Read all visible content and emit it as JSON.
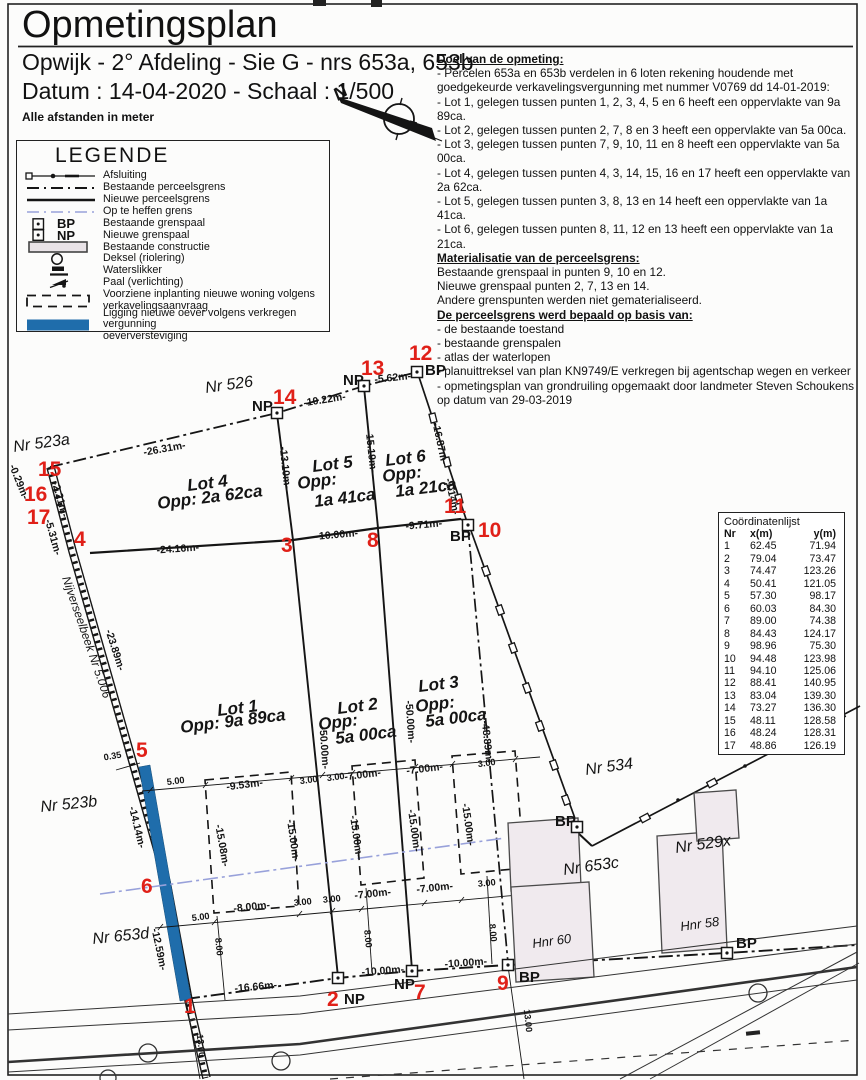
{
  "header": {
    "title": "Opmetingsplan",
    "subtitle": "Opwijk - 2° Afdeling - Sie G - nrs 653a, 653b",
    "date_scale": "Datum : 14-04-2020  -  Schaal : 1/500",
    "units_note": "Alle afstanden in meter",
    "north_label": "N"
  },
  "notes": {
    "s1_title": "Doel van de opmeting:",
    "s1_lines": [
      "- Percelen 653a en 653b verdelen in 6 loten rekening houdende met goedgekeurde verkavelingsvergunning met nummer V0769 dd 14-01-2019:",
      "- Lot 1, gelegen tussen punten 1, 2, 3, 4, 5 en 6 heeft een oppervlakte van 9a 89ca.",
      "- Lot 2, gelegen tussen punten 2, 7, 8 en 3 heeft een oppervlakte van 5a 00ca.",
      "- Lot 3, gelegen tussen punten 7, 9, 10, 11 en 8 heeft een oppervlakte van 5a 00ca.",
      "- Lot 4, gelegen tussen punten 4, 3, 14, 15, 16 en 17 heeft een oppervlakte van 2a 62ca.",
      "- Lot 5, gelegen tussen punten 3, 8, 13 en 14 heeft een oppervlakte van 1a 41ca.",
      "- Lot 6, gelegen tussen punten 8, 11, 12 en 13 heeft een oppervlakte van 1a 21ca."
    ],
    "s2_title": "Materialisatie van de perceelsgrens:",
    "s2_lines": [
      "Bestaande grenspaal in punten 9, 10 en 12.",
      "Nieuwe grenspaal punten 2, 7, 13 en 14.",
      "Andere grenspunten werden niet gematerialiseerd."
    ],
    "s3_title": "De perceelsgrens werd bepaald op basis van:",
    "s3_lines": [
      "- de bestaande toestand",
      "- bestaande grenspalen",
      "- atlas der waterlopen",
      "- planuittreksel van plan KN9749/E verkregen bij agentschap wegen en verkeer",
      "- opmetingsplan van grondruiling opgemaakt door landmeter Steven Schoukens op datum van 29-03-2019"
    ]
  },
  "legend": {
    "title": "LEGENDE",
    "bp": "BP",
    "np": "NP",
    "items": [
      {
        "lines": [
          "Afsluiting"
        ]
      },
      {
        "lines": [
          "Bestaande perceelsgrens"
        ]
      },
      {
        "lines": [
          "Nieuwe perceelsgrens"
        ]
      },
      {
        "lines": [
          "Op te heffen grens"
        ]
      },
      {
        "lines": [
          "Bestaande grenspaal"
        ]
      },
      {
        "lines": [
          "Nieuwe grenspaal"
        ]
      },
      {
        "lines": [
          "Bestaande constructie"
        ]
      },
      {
        "lines": [
          "Deksel (riolering)"
        ]
      },
      {
        "lines": [
          "Waterslikker"
        ]
      },
      {
        "lines": [
          "Paal (verlichting)"
        ]
      },
      {
        "lines": [
          "Voorziene inplanting nieuwe woning volgens",
          "verkavelingsaanvraag"
        ]
      },
      {
        "lines": [
          "Ligging nieuwe oever volgens verkregen vergunning",
          "oeverversteviging"
        ]
      }
    ]
  },
  "coord_table": {
    "title": "Coördinatenlijst",
    "columns": [
      "Nr",
      "x(m)",
      "y(m)"
    ],
    "rows": [
      [
        "1",
        "62.45",
        "71.94"
      ],
      [
        "2",
        "79.04",
        "73.47"
      ],
      [
        "3",
        "74.47",
        "123.26"
      ],
      [
        "4",
        "50.41",
        "121.05"
      ],
      [
        "5",
        "57.30",
        "98.17"
      ],
      [
        "6",
        "60.03",
        "84.30"
      ],
      [
        "7",
        "89.00",
        "74.38"
      ],
      [
        "8",
        "84.43",
        "124.17"
      ],
      [
        "9",
        "98.96",
        "75.30"
      ],
      [
        "10",
        "94.48",
        "123.98"
      ],
      [
        "11",
        "94.10",
        "125.06"
      ],
      [
        "12",
        "88.41",
        "140.95"
      ],
      [
        "13",
        "83.04",
        "139.30"
      ],
      [
        "14",
        "73.27",
        "136.30"
      ],
      [
        "15",
        "48.11",
        "128.58"
      ],
      [
        "16",
        "48.24",
        "128.31"
      ],
      [
        "17",
        "48.86",
        "126.19"
      ]
    ]
  },
  "plan": {
    "colors": {
      "accent_red": "#e02018",
      "water_blue": "#1f6dab",
      "removed_boundary_blue": "#98a1da",
      "building_fill": "#f0eaee"
    },
    "parcel_labels": [
      "Nr 526",
      "Nr 523a",
      "Nr 523b",
      "Nr 653d",
      "Nr 534",
      "Nr 653c",
      "Nr 529x",
      "Hnr 60",
      "Hnr 58",
      "Nijverseelbeek Nr 5.006"
    ],
    "lots": [
      {
        "lines": [
          "Lot 4",
          "Opp: 2a 62ca"
        ]
      },
      {
        "lines": [
          "Lot 5",
          "Opp:",
          "1a 41ca"
        ]
      },
      {
        "lines": [
          "Lot 6",
          "Opp:",
          "1a 21ca"
        ]
      },
      {
        "lines": [
          "Lot 1",
          "Opp: 9a 89ca"
        ]
      },
      {
        "lines": [
          "Lot 2",
          "Opp:",
          "5a 00ca"
        ]
      },
      {
        "lines": [
          "Lot 3",
          "Opp:",
          "5a 00ca"
        ]
      }
    ],
    "points": [
      {
        "n": "1"
      },
      {
        "n": "2",
        "tag": "NP"
      },
      {
        "n": "3"
      },
      {
        "n": "4"
      },
      {
        "n": "5"
      },
      {
        "n": "6"
      },
      {
        "n": "7",
        "tag": "NP"
      },
      {
        "n": "8"
      },
      {
        "n": "9",
        "tag": "BP"
      },
      {
        "n": "10",
        "tag": "BP"
      },
      {
        "n": "11"
      },
      {
        "n": "12",
        "tag": "BP"
      },
      {
        "n": "13",
        "tag": "NP"
      },
      {
        "n": "14",
        "tag": "NP"
      },
      {
        "n": "15"
      },
      {
        "n": "16"
      },
      {
        "n": "17"
      }
    ],
    "extra_markers": [
      "BP",
      "BP"
    ],
    "measurements": [
      "-26.31m-",
      "-10.22m-",
      "-5.62m-",
      "-13.10m-",
      "-15.19m-",
      "-16.87m-",
      "-1.14m-",
      "-0.29m-",
      "-2.21m-",
      "-5.31m-",
      "-24.16m-",
      "-10.00m-",
      "-9.71m-",
      "-23.89m-",
      "-14.14m-",
      "-12.59m-",
      "-16.66m-",
      "-50.00m-",
      "-50.00m-",
      "-48.89m-",
      "0.35",
      "5.00",
      "-9.53m-",
      "-15.08m-",
      "-15.00m-",
      "-15.00m-",
      "-15.00m-",
      "-15.00m-",
      "-8.00m-",
      "3.00",
      "3.00",
      "-7.00m-",
      "-7.00m-",
      "3.00",
      "5.00",
      "8.00",
      "8.00",
      "8.00",
      "-10.00m-",
      "-10.00m-",
      "13.00",
      "13.00",
      "-7.00m-",
      "-7.00m-",
      "3.00",
      "3.00",
      "3.00"
    ]
  }
}
